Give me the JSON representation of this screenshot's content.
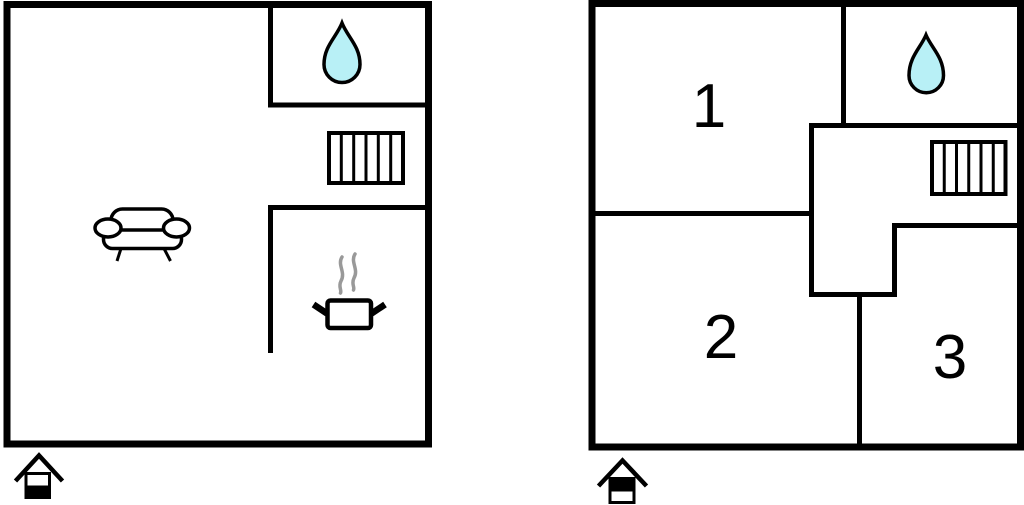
{
  "colors": {
    "wall": "#000000",
    "water_drop_fill": "#b8f0f6",
    "water_drop_stroke": "#000000",
    "steam": "#999999",
    "background": "#ffffff"
  },
  "plans": {
    "left": {
      "icons": [
        "water-drop",
        "radiator",
        "sofa",
        "cooking-pot-with-steam",
        "house-level-indicator-lower-filled"
      ],
      "rooms": []
    },
    "right": {
      "icons": [
        "water-drop",
        "radiator",
        "house-level-indicator-upper-filled"
      ],
      "rooms": [
        {
          "label": "1"
        },
        {
          "label": "2"
        },
        {
          "label": "3"
        }
      ]
    }
  }
}
